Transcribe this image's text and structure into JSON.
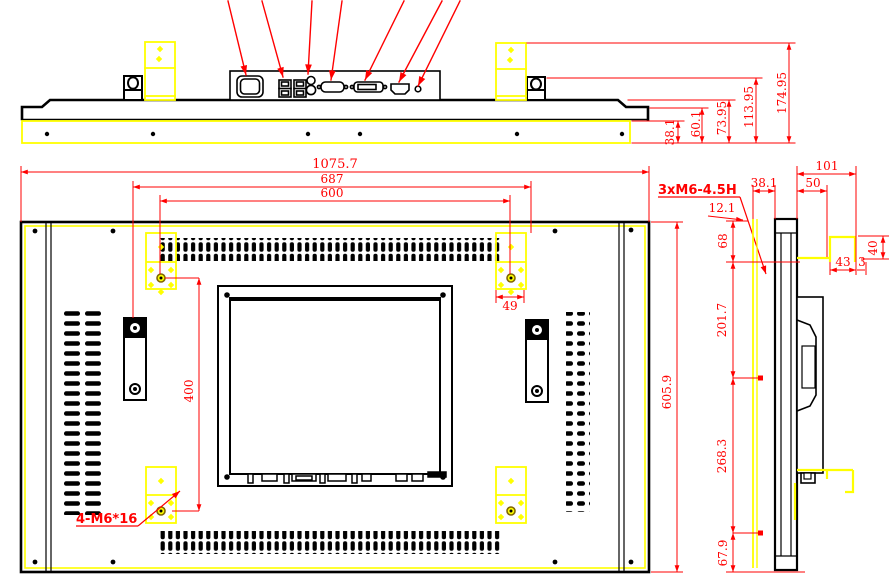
{
  "drawing": {
    "type": "engineering-3-view-drawing",
    "subject": "industrial panel monitor outline dimensions",
    "colors": {
      "geometry": "#000000",
      "dimension": "#ff0000",
      "highlight": "#ffff00"
    }
  },
  "top_view": {
    "dims": [
      "38.1",
      "60.1",
      "73.95",
      "113.95",
      "174.95"
    ],
    "ports": [
      "power-inlet",
      "usb-ports",
      "audio-jacks",
      "vga-port",
      "dvi-port",
      "hdmi-port",
      "dc-jack"
    ]
  },
  "back_view": {
    "dims": {
      "overall_width": "1075.7",
      "outer_mount_width": "687",
      "vesa_hole_width": "600",
      "bracket_width": "49",
      "vesa_hole_height": "400",
      "overall_height": "605.9"
    },
    "labels": {
      "vesa_thread": "3xM6-4.5H",
      "bracket_screw": "4-M6*16"
    }
  },
  "side_view": {
    "dims": {
      "overall_depth": "101",
      "rear_depth": "50",
      "front_depth": "38.1",
      "top_inset": "12.1",
      "top_section": "68",
      "upper_section": "201.7",
      "lower_section": "268.3",
      "bottom_section": "67.9",
      "hook_height": "40",
      "hook_depth": "43",
      "hook_gap": "3"
    }
  }
}
